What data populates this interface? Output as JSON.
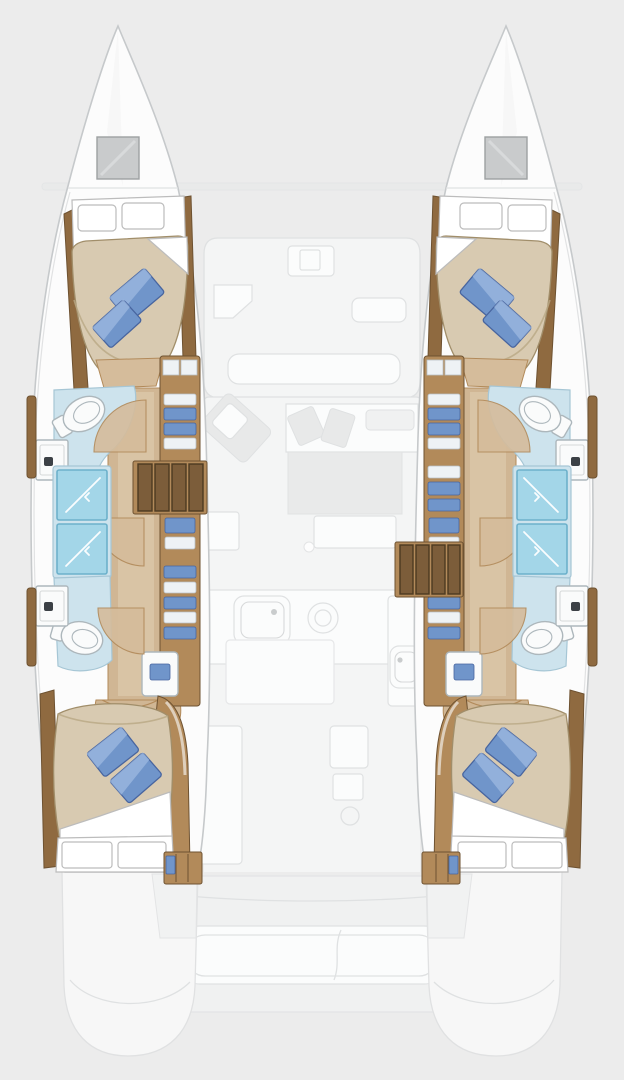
{
  "image": {
    "kind": "yacht-floor-plan",
    "vessel_type": "catamaran",
    "view": "overhead-deck-plan",
    "description": "Top-down floor plan of a four-cabin sailing catamaran. The two symmetrical hulls are drawn in full color, each with a forward double cabin, forward bathroom, twin shower compartments, companionway stairs, aft bathroom and aft double cabin. The central bridgedeck (forward cockpit, saloon, galley, aft cockpit and swim platforms) is shown as faded grey linework."
  },
  "colors": {
    "background": "#ececec",
    "ghost_fill": "#f4f5f5",
    "ghost_white": "#fbfcfc",
    "ghost_block": "#e8e9e9",
    "ghost_stroke": "#dfe1e2",
    "hull_fill": "#fcfcfc",
    "hull_stroke": "#c6c9cb",
    "hatch_fill": "#c9cbcc",
    "hatch_stroke": "#9da0a2",
    "wood_dark": "#8f6a40",
    "wood_mid": "#b28a5a",
    "wood_edge": "#6e5231",
    "wood_light": "#d5bc9b",
    "wood_floor": "#d0b694",
    "floor_light": "#e0cfb2",
    "stair_tread": "#7c5d3a",
    "stair_gap": "#4d3a22",
    "bath_floor": "#cde3ed",
    "bath_stroke": "#a6c6d5",
    "shower_fill": "#a3d6e8",
    "shower_stroke": "#6db1cb",
    "fixture_fill": "#fafbfb",
    "fixture_stroke": "#adb7bc",
    "bed_duvet": "#d8cab1",
    "bed_shade": "#b9a785",
    "bed_stroke": "#a18e6a",
    "linen_white": "#ffffff",
    "linen_stroke": "#bcbcbc",
    "pillow_blue": "#7095ca",
    "pillow_dark": "#48659f",
    "pillow_light": "#a5bee3",
    "shelf_white": "#eef2f5",
    "shelf_stroke": "#b9c0c6",
    "faucet_dark": "#3c4146"
  },
  "layout": {
    "port_hull": {
      "rooms": [
        "forward-double-cabin",
        "forward-bathroom",
        "shower-compartments",
        "companionway-stairs",
        "aft-bathroom",
        "aft-double-cabin"
      ],
      "fixtures": [
        "bow-hatch",
        "double-berth",
        "blue-throw-pillows",
        "toilet",
        "washbasin-cabinet",
        "shower-x2",
        "linen-shelves",
        "stairs",
        "wardrobe",
        "stern-locker"
      ]
    },
    "starboard_hull": {
      "rooms": [
        "forward-double-cabin",
        "forward-bathroom",
        "shower-compartments",
        "companionway-stairs",
        "aft-bathroom",
        "aft-double-cabin"
      ],
      "fixtures": [
        "bow-hatch",
        "double-berth",
        "blue-throw-pillows",
        "toilet",
        "washbasin-cabinet",
        "shower-x2",
        "linen-shelves",
        "stairs",
        "wardrobe",
        "stern-locker"
      ]
    },
    "centerline_areas": [
      "forward-crossbeam",
      "anchor-locker",
      "forward-cockpit-lounge",
      "saloon-sofa",
      "saloon-table",
      "galley-sink",
      "galley-stove",
      "galley-island",
      "aft-cabinet",
      "aft-cockpit-bench",
      "swim-platforms"
    ]
  },
  "counts": {
    "cabins": 4,
    "bathrooms": 4,
    "showers": 4,
    "blue_pillows": 8,
    "stairways": 2
  }
}
